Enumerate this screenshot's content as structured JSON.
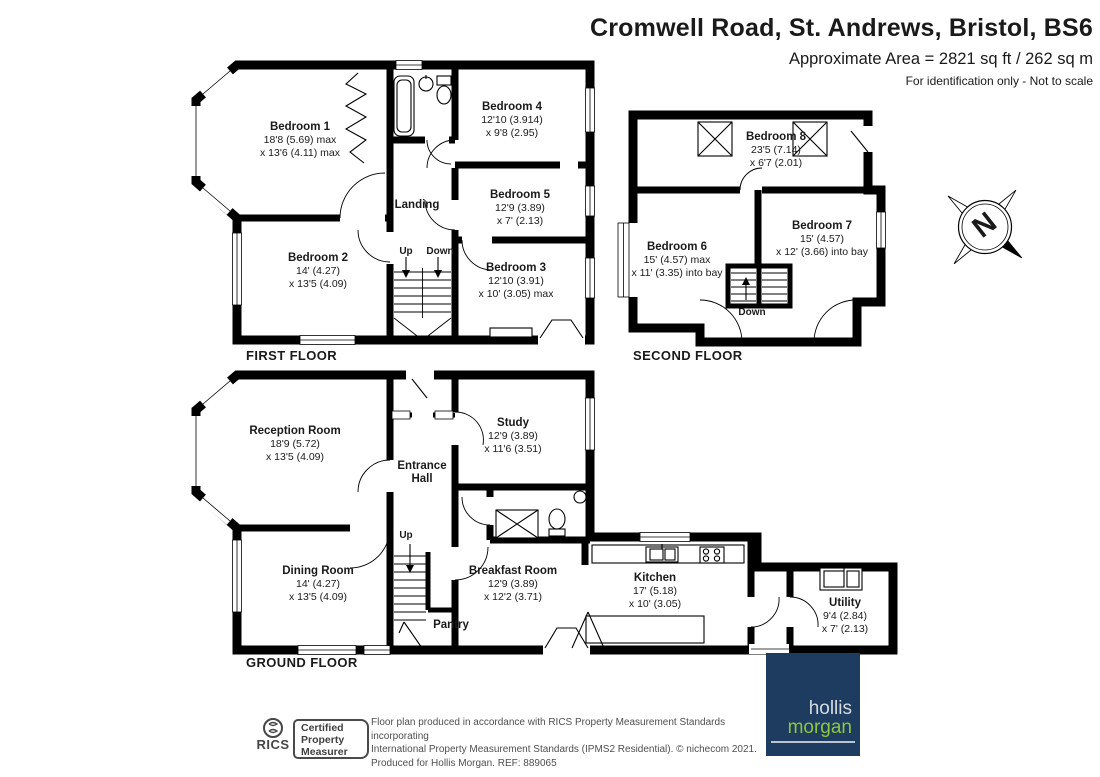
{
  "header": {
    "title": "Cromwell Road, St. Andrews, Bristol, BS6",
    "area": "Approximate Area = 2821 sq ft / 262 sq m",
    "disclaimer": "For identification only - Not to scale"
  },
  "floors": {
    "first": {
      "label": "FIRST FLOOR",
      "landing": "Landing",
      "up": "Up",
      "down": "Down",
      "bedroom1": {
        "name": "Bedroom 1",
        "dim1": "18'8 (5.69) max",
        "dim2": "x 13'6 (4.11) max"
      },
      "bedroom2": {
        "name": "Bedroom 2",
        "dim1": "14' (4.27)",
        "dim2": "x 13'5 (4.09)"
      },
      "bedroom3": {
        "name": "Bedroom 3",
        "dim1": "12'10 (3.91)",
        "dim2": "x 10' (3.05) max"
      },
      "bedroom4": {
        "name": "Bedroom 4",
        "dim1": "12'10 (3.914)",
        "dim2": "x 9'8 (2.95)"
      },
      "bedroom5": {
        "name": "Bedroom 5",
        "dim1": "12'9 (3.89)",
        "dim2": "x 7' (2.13)"
      }
    },
    "second": {
      "label": "SECOND FLOOR",
      "down": "Down",
      "bedroom6": {
        "name": "Bedroom 6",
        "dim1": "15' (4.57) max",
        "dim2": "x 11' (3.35) into bay"
      },
      "bedroom7": {
        "name": "Bedroom 7",
        "dim1": "15' (4.57)",
        "dim2": "x 12' (3.66) into bay"
      },
      "bedroom8": {
        "name": "Bedroom 8",
        "dim1": "23'5 (7.14)",
        "dim2": "x 6'7 (2.01)"
      }
    },
    "ground": {
      "label": "GROUND FLOOR",
      "entrance_line1": "Entrance",
      "entrance_line2": "Hall",
      "pantry": "Pantry",
      "up": "Up",
      "reception": {
        "name": "Reception Room",
        "dim1": "18'9 (5.72)",
        "dim2": "x 13'5 (4.09)"
      },
      "study": {
        "name": "Study",
        "dim1": "12'9 (3.89)",
        "dim2": "x 11'6 (3.51)"
      },
      "dining": {
        "name": "Dining Room",
        "dim1": "14' (4.27)",
        "dim2": "x 13'5 (4.09)"
      },
      "breakfast": {
        "name": "Breakfast Room",
        "dim1": "12'9 (3.89)",
        "dim2": "x 12'2 (3.71)"
      },
      "kitchen": {
        "name": "Kitchen",
        "dim1": "17' (5.18)",
        "dim2": "x 10' (3.05)"
      },
      "utility": {
        "name": "Utility",
        "dim1": "9'4 (2.84)",
        "dim2": "x 7' (2.13)"
      }
    }
  },
  "compass": {
    "north": "N"
  },
  "footer": {
    "rics_brand": "RICS",
    "cert1": "Certified",
    "cert2": "Property",
    "cert3": "Measurer",
    "line1": "Floor plan produced in accordance with RICS Property Measurement Standards incorporating",
    "line2": "International Property Measurement Standards (IPMS2 Residential). © nichecom 2021.",
    "line3": "Produced for Hollis Morgan. REF: 889065",
    "brand1": "hollis",
    "brand2": "morgan"
  },
  "colors": {
    "navy": "#1d3c60",
    "green": "#8dc63f",
    "wall": "#000000"
  }
}
